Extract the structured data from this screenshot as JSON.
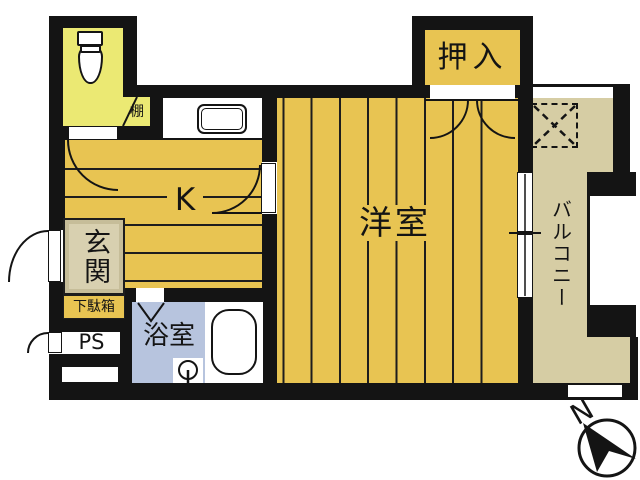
{
  "plan": {
    "labels": {
      "shelf": "棚",
      "closet": "押入",
      "kitchen": "K",
      "western_room": "洋室",
      "entrance": "玄関",
      "shoe_cabinet": "下駄箱",
      "pipe_space": "PS",
      "bathroom": "浴室",
      "balcony": "バルコニー"
    },
    "compass": {
      "north_label": "N"
    },
    "colors": {
      "wall": "#141414",
      "floor_gold": "#e8c452",
      "toilet_yellow": "#ebe973",
      "entrance_beige": "#d8d0b0",
      "bathroom_blue": "#b7c4de",
      "balcony_khaki": "#d6cda4",
      "background": "#ffffff"
    }
  }
}
